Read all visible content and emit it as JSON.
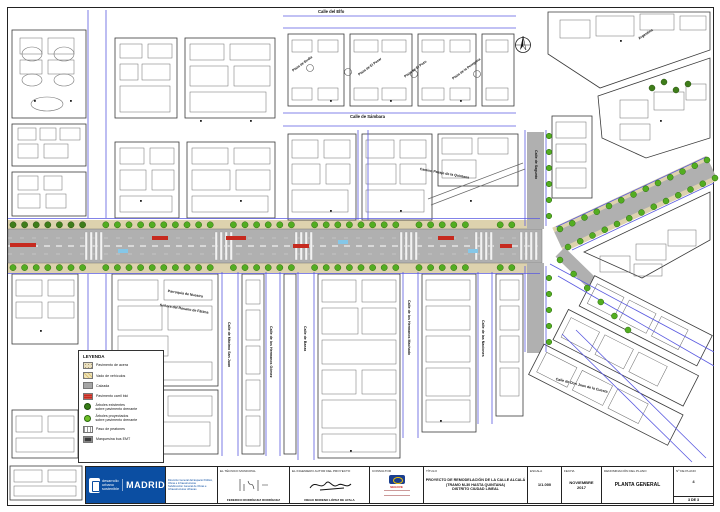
{
  "colors": {
    "street_blue": "#5a5ae0",
    "road_gray": "#b0b0b0",
    "sidewalk": "#ddd2ae",
    "tree_green": "#53ad21",
    "tree_dark": "#3f7d1a",
    "bici_red": "#c62a1f",
    "madrid_blue": "#0b4ea2"
  },
  "map_labels": {
    "elfo": "Calle del Elfo",
    "sambara": "Calle de Sámbara",
    "plaza1": "Plaza de Budia",
    "plaza2": "Plaza de El Pesar",
    "plaza3": "Plaza de El Pozo",
    "plaza4": "Plaza de la Peregrina",
    "pasaje": "Camino Pasaje de la Quintana",
    "sagunto": "Calle de Sagunto",
    "argentina": "Argentina",
    "parroquia1": "Parroquia de Nuestra",
    "parroquia2": "Señora del Rosario de Fátima",
    "maximo": "Calle de Máximo San Juan",
    "hermanos_gomez": "Calle de los Hermanos Gómez",
    "baeza": "Calle de Baeza",
    "hermanos_machado": "Calle de los Hermanos Machado",
    "naciones": "Calle de las Naciones",
    "cuesta": "Calle de Don Juan de la Cuesta"
  },
  "legend": {
    "title": "LEYENDA",
    "items": [
      {
        "type": "acera",
        "label": "Pavimento de acera",
        "label2": ""
      },
      {
        "type": "vado",
        "label": "Vado de vehículos",
        "label2": ""
      },
      {
        "type": "calzada",
        "label": "Calzada",
        "label2": ""
      },
      {
        "type": "bici",
        "label": "Pavimento carril bici",
        "label2": ""
      },
      {
        "type": "arbol-e",
        "label": "Árboles existentes",
        "label2": "sobre pavimento drenante"
      },
      {
        "type": "arbol-p",
        "label": "Árboles proyectados",
        "label2": "sobre pavimento drenante"
      },
      {
        "type": "paso",
        "label": "Paso de peatones",
        "label2": ""
      },
      {
        "type": "marq",
        "label": "Marquesina bus EMT",
        "label2": ""
      }
    ]
  },
  "title_block": {
    "logo": {
      "line1": "desarrollo urbano",
      "line2": "sostenible",
      "brand": "MADRID"
    },
    "dept_lines": [
      "Dirección General del Espacio Público,",
      "Obras e Infraestructuras",
      "Subdirección General de Obras e",
      "Infraestructuras Urbanas"
    ],
    "tecnico": {
      "label": "EL TÉCNICO MUNICIPAL",
      "name": "FEDERICO RODRÍGUEZ RODRÍGUEZ"
    },
    "ingeniero": {
      "label": "EL INGENIERO AUTOR DEL PROYECTO",
      "name": "DIEGO MORENO LÓPEZ DE AYALA"
    },
    "consultor": {
      "label": "CONSULTOR",
      "brand": "SEGOVE"
    },
    "titulo": {
      "label": "TÍTULO",
      "line1": "PROYECTO DE REMODELACIÓN DE LA CALLE ALCALÁ",
      "line2": "(TRAMO M-30 HASTA QUINTANA)",
      "line3": "DISTRITO CIUDAD LINEAL"
    },
    "escala": {
      "label": "ESCALA",
      "value": "1/1.000"
    },
    "fecha": {
      "label": "FECHA",
      "line1": "NOVIEMBRE",
      "line2": "2017"
    },
    "denominacion": {
      "label": "DENOMINACIÓN DEL PLANO",
      "value": "PLANTA GENERAL"
    },
    "num_plano": {
      "label": "Nº DE PLANO",
      "value": "4",
      "sub": "3 DE 3"
    }
  }
}
